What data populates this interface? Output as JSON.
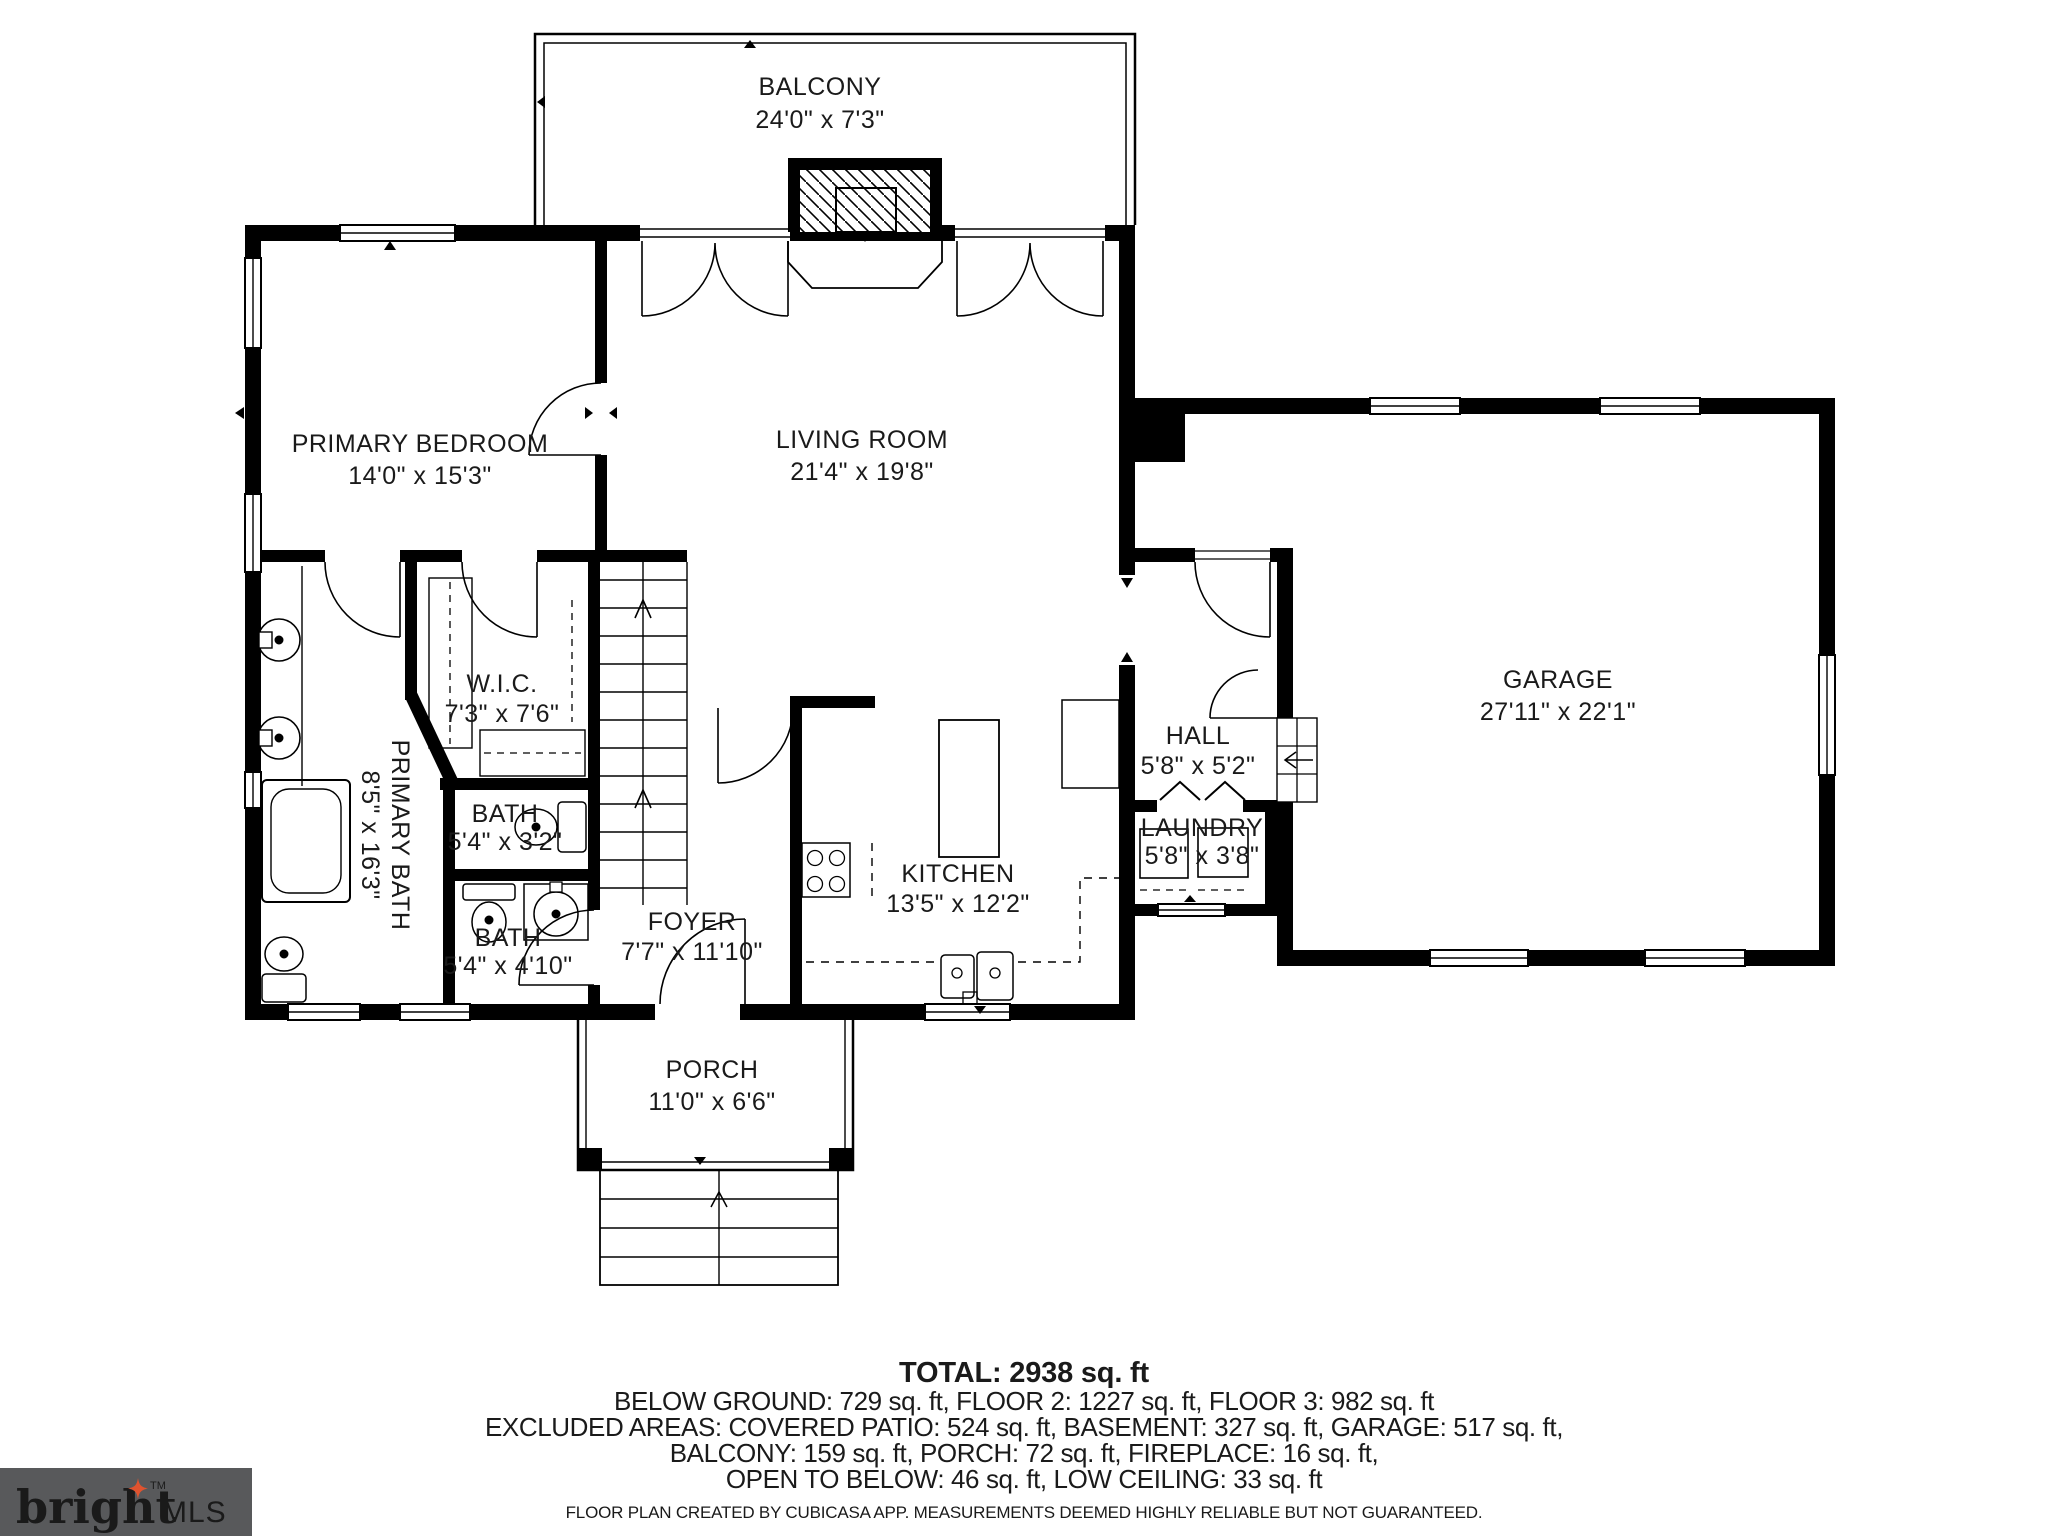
{
  "rooms": [
    {
      "name": "BALCONY",
      "dims": "24'0\" x 7'3\""
    },
    {
      "name": "PRIMARY BEDROOM",
      "dims": "14'0\" x 15'3\""
    },
    {
      "name": "LIVING ROOM",
      "dims": "21'4\" x 19'8\""
    },
    {
      "name": "GARAGE",
      "dims": "27'11\" x 22'1\""
    },
    {
      "name": "W.I.C.",
      "dims": "7'3\" x 7'6\""
    },
    {
      "name": "PRIMARY BATH",
      "dims": "8'5\" x 16'3\""
    },
    {
      "name": "BATH",
      "dims": "5'4\" x 3'2\""
    },
    {
      "name": "BATH",
      "dims": "5'4\" x 4'10\""
    },
    {
      "name": "FOYER",
      "dims": "7'7\" x 11'10\""
    },
    {
      "name": "KITCHEN",
      "dims": "13'5\" x 12'2\""
    },
    {
      "name": "HALL",
      "dims": "5'8\" x 5'2\""
    },
    {
      "name": "LAUNDRY",
      "dims": "5'8\" x 3'8\""
    },
    {
      "name": "PORCH",
      "dims": "11'0\" x 6'6\""
    }
  ],
  "summary": {
    "total": "TOTAL: 2938 sq. ft",
    "line1": "BELOW GROUND: 729 sq. ft, FLOOR 2: 1227 sq. ft, FLOOR 3: 982 sq. ft",
    "line2": "EXCLUDED AREAS: COVERED PATIO: 524 sq. ft, BASEMENT: 327 sq. ft, GARAGE: 517 sq. ft,",
    "line3": "BALCONY: 159 sq. ft, PORCH: 72 sq. ft, FIREPLACE: 16 sq. ft,",
    "line4": "OPEN TO BELOW: 46 sq. ft, LOW CEILING: 33 sq. ft"
  },
  "footer": {
    "disclaimer": "FLOOR PLAN CREATED BY CUBICASA APP. MEASUREMENTS DEEMED HIGHLY RELIABLE BUT NOT GUARANTEED."
  },
  "logo": {
    "brand": "bright",
    "tm": "TM",
    "suffix": "MLS"
  },
  "colors": {
    "wall": "#000000",
    "background": "#ffffff",
    "logo_bg": "#58595b",
    "logo_text": "#d9d9da",
    "logo_mls": "#9b9da0",
    "logo_star": "#e0532f"
  }
}
